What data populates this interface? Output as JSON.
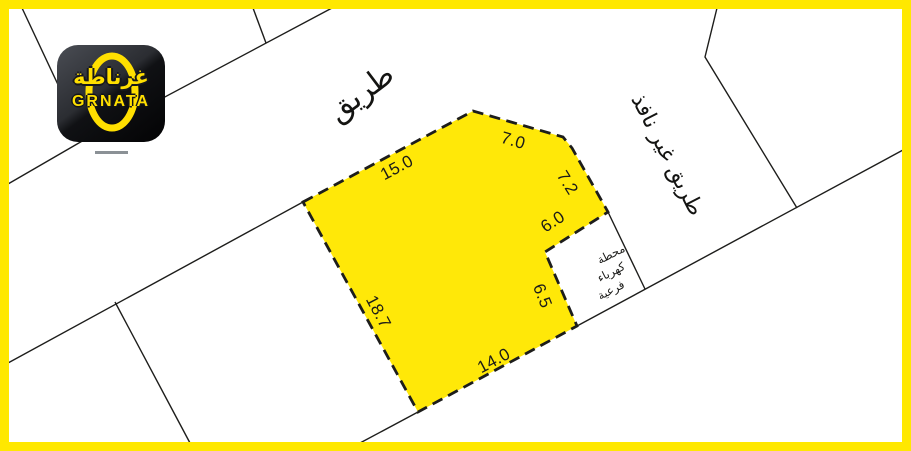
{
  "brand": {
    "logo_arabic": "غرناطة",
    "logo_latin": "GRNATA"
  },
  "map": {
    "road_label_top": "طريق",
    "road_label_right": "طريق غير نافذ",
    "substation_lines": [
      "محطة",
      "كهرباء",
      "فرعية"
    ],
    "dimensions": [
      "15.0",
      "7.0",
      "7.2",
      "6.0",
      "6.5",
      "18.7",
      "14.0"
    ]
  },
  "colors": {
    "frame_yellow": "#FFE800",
    "plot_fill_yellow": "#FFE808",
    "line_black": "#1D1D1B",
    "logo_yellow": "#FFDF00",
    "logo_background": "#17181C"
  }
}
